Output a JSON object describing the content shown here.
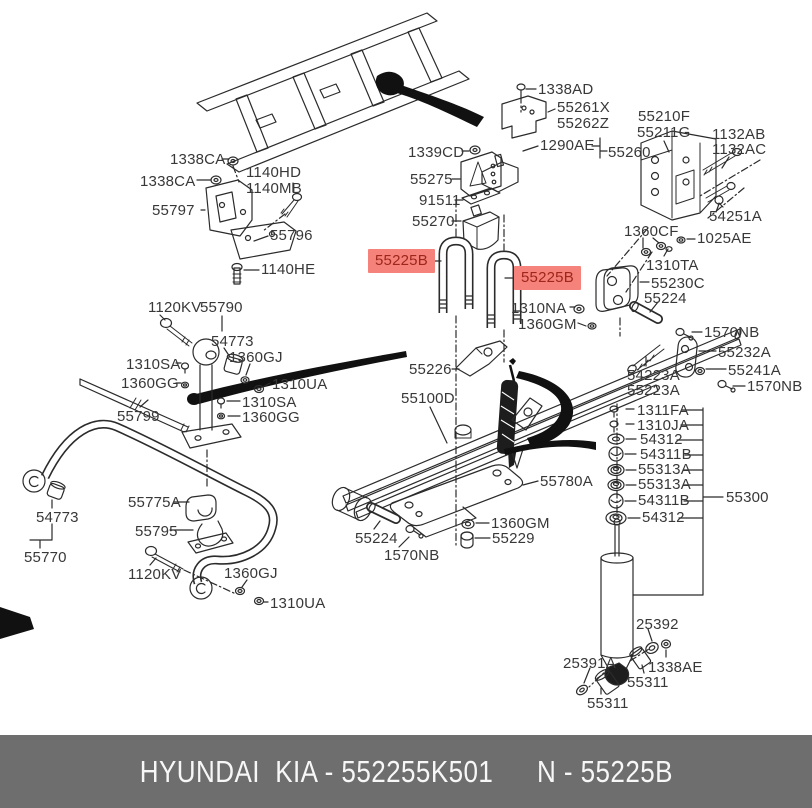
{
  "footer": {
    "left": "HYUNDAI  KIA - 552255K501",
    "right": "N - 55225B"
  },
  "colors": {
    "footer_bg": "#6e6e6e",
    "footer_text": "#f7f7f7",
    "highlight_bg": "#f5837b",
    "highlight_text": "#9e261b",
    "line": "#2b2b2b"
  },
  "labels": [
    {
      "text": "1338CA",
      "x": 170,
      "y": 151
    },
    {
      "text": "1338CA",
      "x": 140,
      "y": 173
    },
    {
      "text": "1140HD",
      "x": 246,
      "y": 164
    },
    {
      "text": "1140MB",
      "x": 246,
      "y": 180
    },
    {
      "text": "55797",
      "x": 152,
      "y": 202
    },
    {
      "text": "55796",
      "x": 270,
      "y": 227
    },
    {
      "text": "1140HE",
      "x": 261,
      "y": 261
    },
    {
      "text": "1338AD",
      "x": 538,
      "y": 81
    },
    {
      "text": "55261X",
      "x": 557,
      "y": 99
    },
    {
      "text": "55262Z",
      "x": 557,
      "y": 115
    },
    {
      "text": "1339CD",
      "x": 408,
      "y": 144
    },
    {
      "text": "1290AE",
      "x": 540,
      "y": 137
    },
    {
      "text": "55260",
      "x": 608,
      "y": 144
    },
    {
      "text": "55275",
      "x": 410,
      "y": 171
    },
    {
      "text": "91511",
      "x": 419,
      "y": 192
    },
    {
      "text": "55270",
      "x": 412,
      "y": 213
    },
    {
      "text": "55210F",
      "x": 638,
      "y": 108
    },
    {
      "text": "55211G",
      "x": 637,
      "y": 124
    },
    {
      "text": "1132AB",
      "x": 712,
      "y": 126
    },
    {
      "text": "1132AC",
      "x": 712,
      "y": 141
    },
    {
      "text": "54251A",
      "x": 709,
      "y": 208
    },
    {
      "text": "1360CF",
      "x": 624,
      "y": 223
    },
    {
      "text": "1025AE",
      "x": 697,
      "y": 230
    },
    {
      "text": "1310TA",
      "x": 646,
      "y": 257
    },
    {
      "text": "55230C",
      "x": 651,
      "y": 275
    },
    {
      "text": "55224",
      "x": 644,
      "y": 290
    },
    {
      "text": "55225B",
      "x": 368,
      "y": 249,
      "highlight": true
    },
    {
      "text": "55225B",
      "x": 514,
      "y": 266,
      "highlight": true
    },
    {
      "text": "1310NA",
      "x": 511,
      "y": 300
    },
    {
      "text": "1360GM",
      "x": 518,
      "y": 316
    },
    {
      "text": "55226",
      "x": 409,
      "y": 361
    },
    {
      "text": "55100D",
      "x": 401,
      "y": 390
    },
    {
      "text": "1570NB",
      "x": 704,
      "y": 324
    },
    {
      "text": "55232A",
      "x": 718,
      "y": 344
    },
    {
      "text": "55241A",
      "x": 728,
      "y": 362
    },
    {
      "text": "1570NB",
      "x": 747,
      "y": 378
    },
    {
      "text": "54223A",
      "x": 627,
      "y": 367
    },
    {
      "text": "55223A",
      "x": 627,
      "y": 382
    },
    {
      "text": "1120KV",
      "x": 148,
      "y": 299
    },
    {
      "text": "55790",
      "x": 200,
      "y": 299
    },
    {
      "text": "54773",
      "x": 211,
      "y": 333
    },
    {
      "text": "1360GJ",
      "x": 229,
      "y": 349
    },
    {
      "text": "1310SA",
      "x": 126,
      "y": 356
    },
    {
      "text": "1360GG",
      "x": 121,
      "y": 375
    },
    {
      "text": "1310UA",
      "x": 272,
      "y": 376
    },
    {
      "text": "1310SA",
      "x": 242,
      "y": 394
    },
    {
      "text": "1360GG",
      "x": 242,
      "y": 409
    },
    {
      "text": "55799",
      "x": 117,
      "y": 408
    },
    {
      "text": "54773",
      "x": 36,
      "y": 509
    },
    {
      "text": "55770",
      "x": 24,
      "y": 549
    },
    {
      "text": "55775A",
      "x": 128,
      "y": 494
    },
    {
      "text": "55795",
      "x": 135,
      "y": 523
    },
    {
      "text": "1120KV",
      "x": 128,
      "y": 566
    },
    {
      "text": "1360GJ",
      "x": 224,
      "y": 565
    },
    {
      "text": "1310UA",
      "x": 270,
      "y": 595
    },
    {
      "text": "55224",
      "x": 355,
      "y": 530
    },
    {
      "text": "1570NB",
      "x": 384,
      "y": 547
    },
    {
      "text": "55780A",
      "x": 540,
      "y": 473
    },
    {
      "text": "1360GM",
      "x": 491,
      "y": 515
    },
    {
      "text": "55229",
      "x": 492,
      "y": 530
    },
    {
      "text": "1311FA",
      "x": 637,
      "y": 402
    },
    {
      "text": "1310JA",
      "x": 637,
      "y": 417
    },
    {
      "text": "54312",
      "x": 640,
      "y": 431
    },
    {
      "text": "54311B",
      "x": 640,
      "y": 446
    },
    {
      "text": "55313A",
      "x": 638,
      "y": 461
    },
    {
      "text": "55313A",
      "x": 638,
      "y": 476
    },
    {
      "text": "54311B",
      "x": 638,
      "y": 492
    },
    {
      "text": "54312",
      "x": 642,
      "y": 509
    },
    {
      "text": "55300",
      "x": 726,
      "y": 489
    },
    {
      "text": "25392",
      "x": 636,
      "y": 616
    },
    {
      "text": "1338AE",
      "x": 648,
      "y": 659
    },
    {
      "text": "25391A",
      "x": 563,
      "y": 655
    },
    {
      "text": "55311",
      "x": 627,
      "y": 674
    },
    {
      "text": "55311",
      "x": 587,
      "y": 695
    }
  ]
}
